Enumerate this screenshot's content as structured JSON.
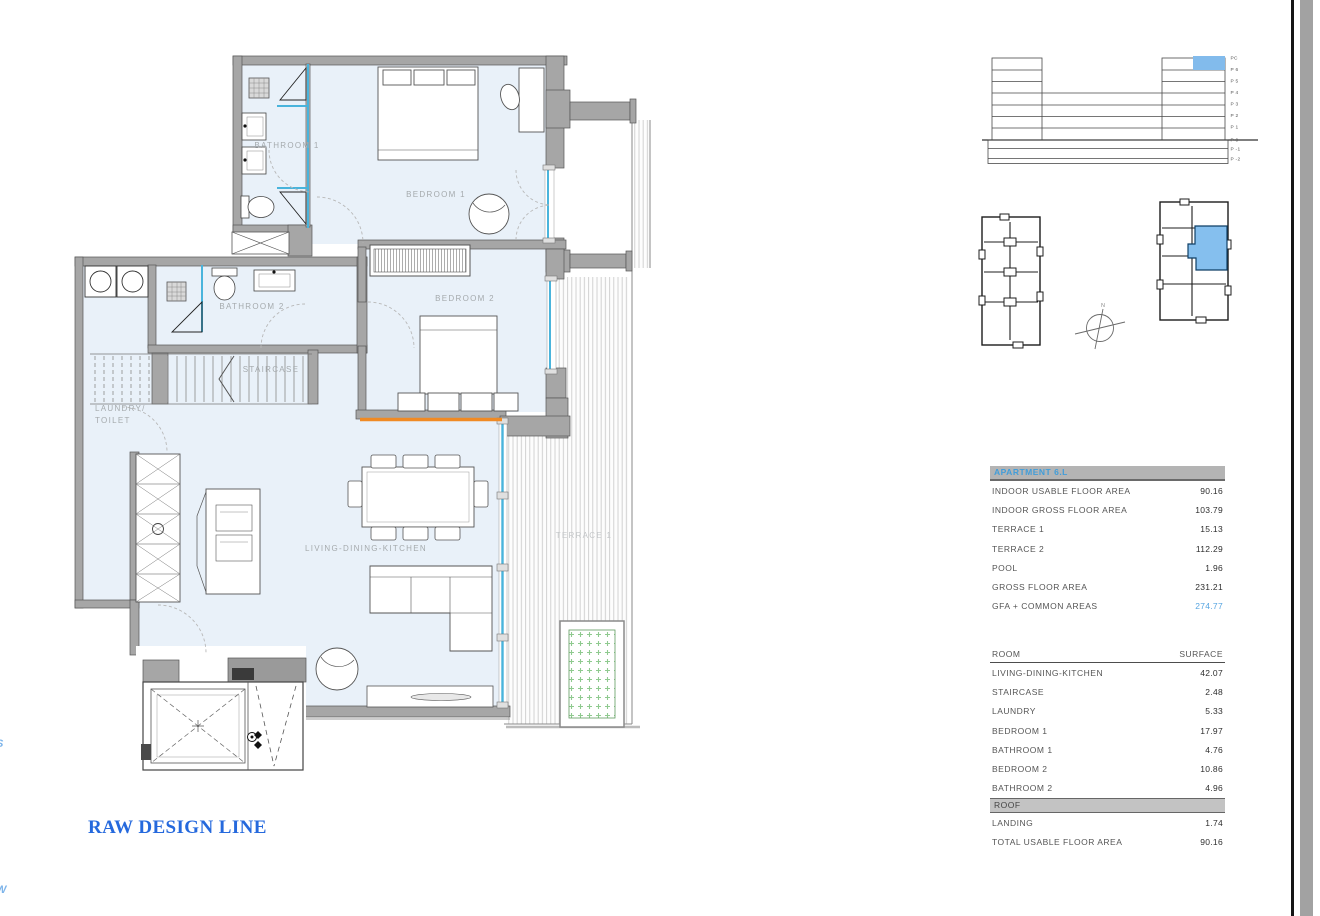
{
  "document": {
    "brand": "RAW DESIGN LINE",
    "edge_fragment_s": "S",
    "edge_fragment_w": "W"
  },
  "colors": {
    "unit_highlight_blue": "#82bbec",
    "glass_blue": "#49b4dc",
    "accent_orange": "#f08a24",
    "brand_blue": "#2569dd",
    "planter_green": "#8fca8f"
  },
  "floorplan": {
    "labels": {
      "bathroom1": "BATHROOM 1",
      "bedroom1": "BEDROOM 1",
      "bedroom2": "BEDROOM 2",
      "bathroom2": "BATHROOM 2",
      "staircase": "STAIRCASE",
      "laundry_line1": "LAUNDRY/",
      "laundry_line2": "TOILET",
      "living": "LIVING-DINING-KITCHEN",
      "terrace1": "TERRACE 1"
    }
  },
  "elevation": {
    "levels": [
      "PC",
      "P 6",
      "P 5",
      "P 4",
      "P 3",
      "P 2",
      "P 1",
      "P 0",
      "P -1",
      "P -2"
    ]
  },
  "compass": {
    "north": "N"
  },
  "apartment_table": {
    "title": "APARTMENT 6.L",
    "rows": [
      {
        "label": "INDOOR USABLE FLOOR AREA",
        "value": "90.16"
      },
      {
        "label": "INDOOR GROSS FLOOR AREA",
        "value": "103.79"
      },
      {
        "label": "TERRACE 1",
        "value": "15.13"
      },
      {
        "label": "TERRACE 2",
        "value": "112.29"
      },
      {
        "label": "POOL",
        "value": "1.96"
      },
      {
        "label": "GROSS FLOOR AREA",
        "value": "231.21"
      },
      {
        "label": "GFA + COMMON AREAS",
        "value": "274.77"
      }
    ]
  },
  "room_table": {
    "header": {
      "room": "ROOM",
      "surface": "SURFACE"
    },
    "rows": [
      {
        "label": "LIVING-DINING-KITCHEN",
        "value": "42.07"
      },
      {
        "label": "STAIRCASE",
        "value": "2.48"
      },
      {
        "label": "LAUNDRY",
        "value": "5.33"
      },
      {
        "label": "BEDROOM 1",
        "value": "17.97"
      },
      {
        "label": "BATHROOM 1",
        "value": "4.76"
      },
      {
        "label": "BEDROOM 2",
        "value": "10.86"
      },
      {
        "label": "BATHROOM 2",
        "value": "4.96"
      }
    ],
    "section": "ROOF",
    "section_rows": [
      {
        "label": "LANDING",
        "value": "1.74"
      },
      {
        "label": "TOTAL USABLE FLOOR AREA",
        "value": "90.16"
      }
    ]
  }
}
